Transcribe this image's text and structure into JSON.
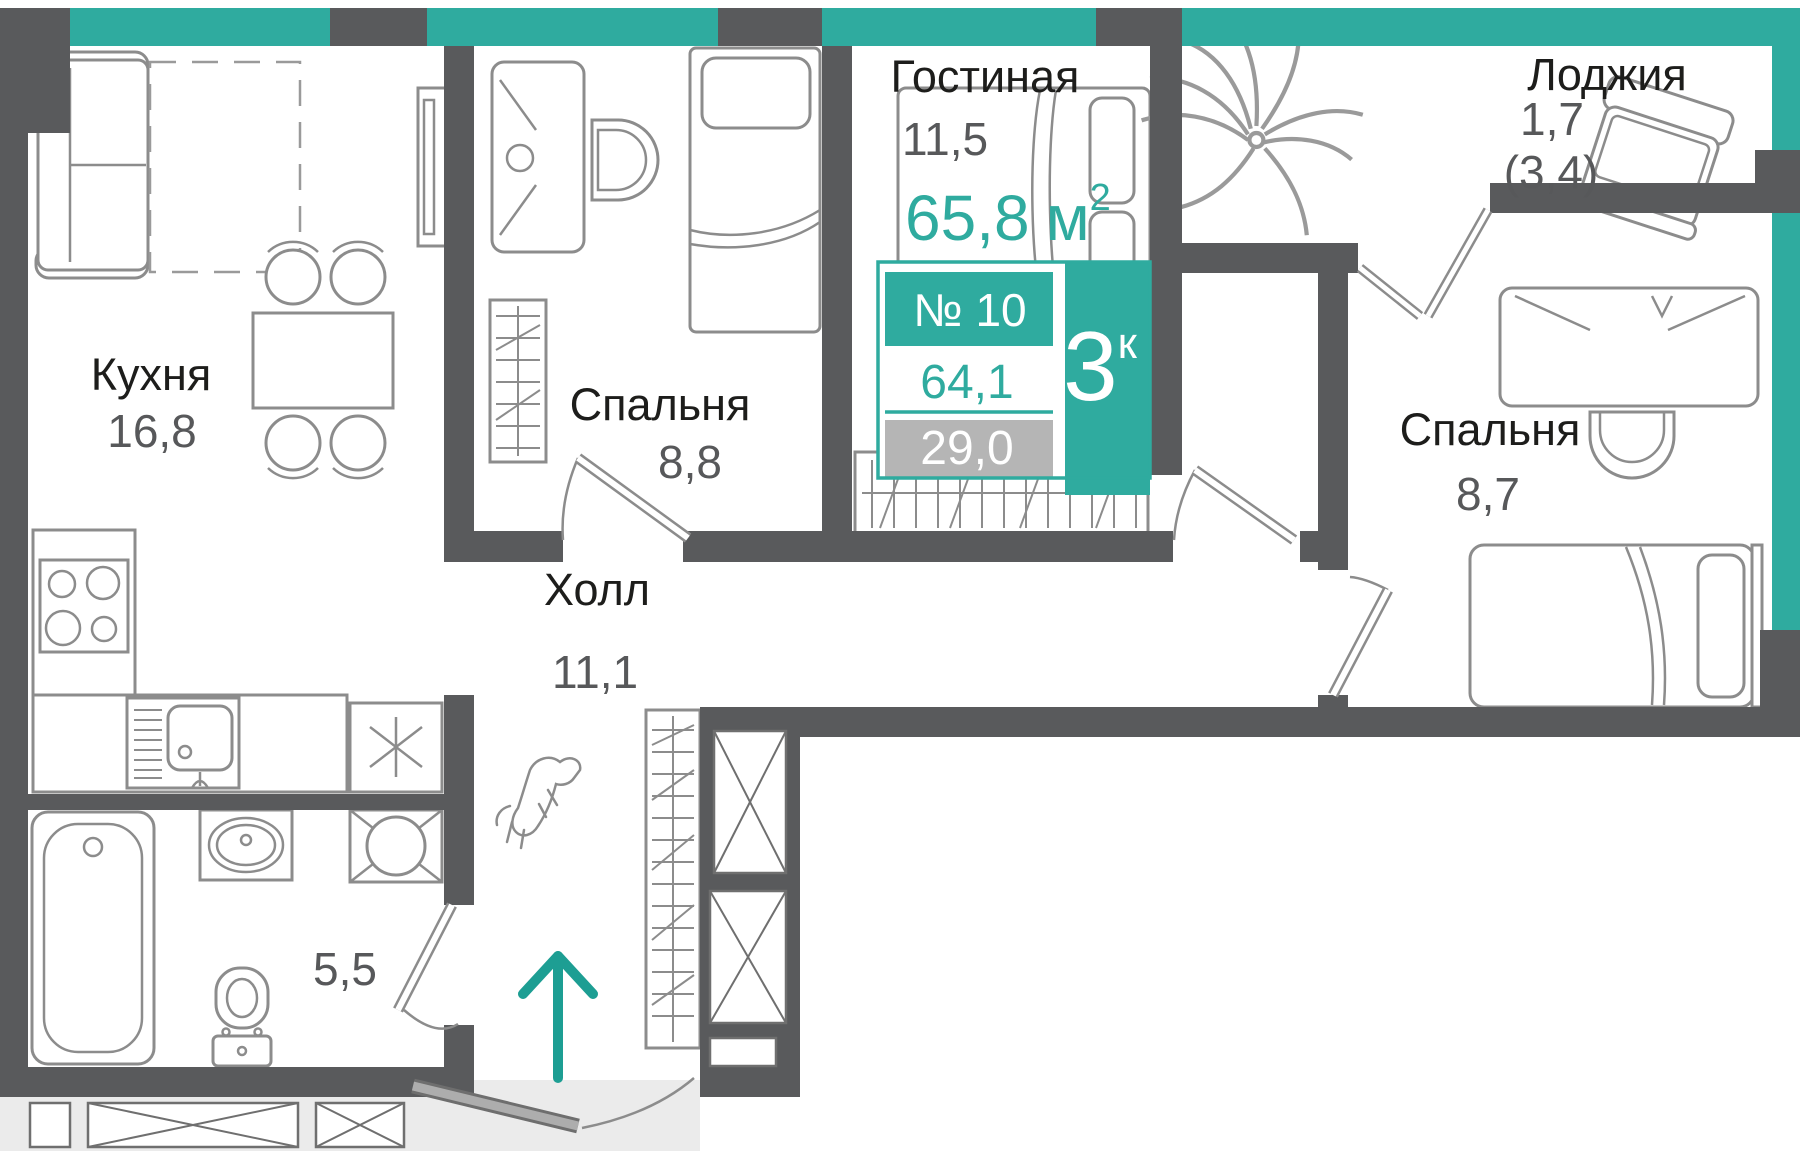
{
  "plan": {
    "total_area": {
      "value": "65,8",
      "unit": "м",
      "sup": "2"
    },
    "badge": {
      "number": "№ 10",
      "rooms": "3",
      "rooms_sup": "к",
      "area_living": "64,1",
      "area_other": "29,0"
    },
    "rooms": {
      "kitchen": {
        "label": "Кухня",
        "area": "16,8"
      },
      "bedroom1": {
        "label": "Спальня",
        "area": "8,8"
      },
      "living": {
        "label": "Гостиная",
        "area": "11,5"
      },
      "loggia": {
        "label": "Лоджия",
        "area": "1,7",
        "area_full": "(3,4)"
      },
      "bedroom2": {
        "label": "Спальня",
        "area": "8,7"
      },
      "hall": {
        "label": "Холл",
        "area": "11,1"
      },
      "bathroom": {
        "area": "5,5"
      }
    },
    "colors": {
      "accent": "#2FAB9F",
      "wall": "#595A5C",
      "furniture": "#8C8C8C",
      "label_text": "#1D1D1B",
      "number_text": "#57585A",
      "badge_gray": "#B5B5B5",
      "outside_gray": "#EBEBEB"
    }
  }
}
